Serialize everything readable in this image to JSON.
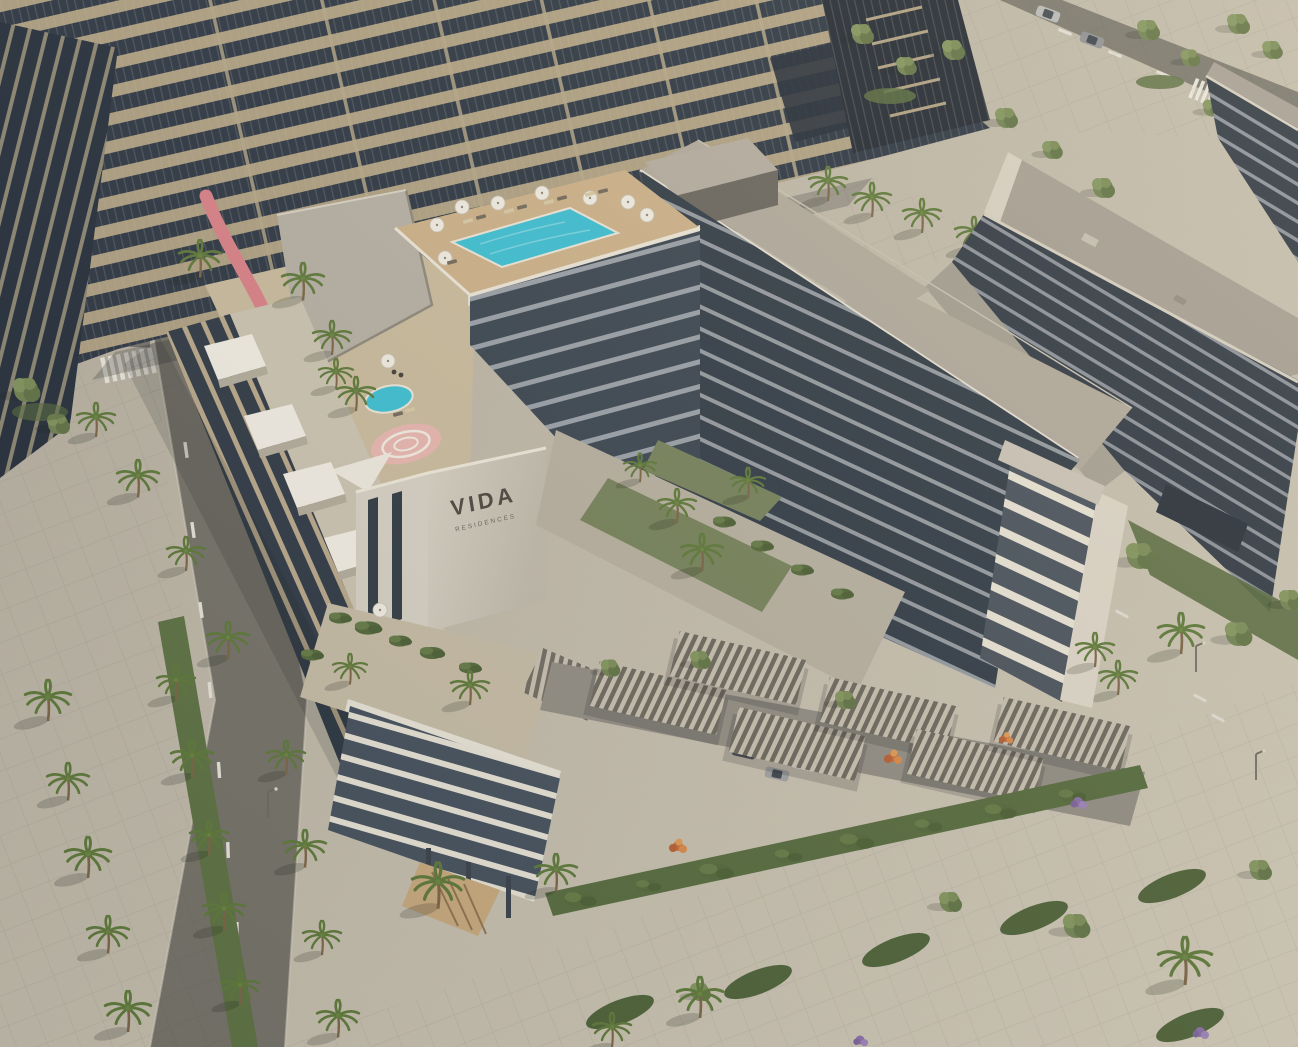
{
  "scene": {
    "type": "aerial-architectural-render",
    "title": "Aerial rendering of the VIDA Residences development",
    "sign": {
      "line1": "VIDA",
      "line2": "RESIDENCES"
    },
    "features": [
      "banded high-rise tower at top left",
      "rooftop infinity pool with parasols and sun loungers",
      "mid-rise apartment blocks with glass balconies",
      "podium deck with pink jogging track and plunge pool",
      "white canopies over roof terraces",
      "inner courtyard lawns with palm trees",
      "slatted carport pergolas with parked cars",
      "palm-lined streets with zebra crossings and lane markings",
      "landscaped promenade with orange and purple flowering shrubs"
    ],
    "palette": {
      "pavement_light": "#cfc8b6",
      "pavement_dark": "#b3ac9e",
      "asphalt": "#7a776f",
      "tower_band_tan": "#b0a183",
      "tower_glass": "#2e3845",
      "facade_glass": "#39434e",
      "white_trim": "#ece6d9",
      "roof_gray": "#b2aa9c",
      "deck_wood": "#cdb28a",
      "pool_water": "#3ec0d3",
      "track_pink": "#db8389",
      "lawn_green": "#77835c",
      "palm_green": "#5f7a3b",
      "shrub_green": "#55693c",
      "flower_orange": "#d98a4a",
      "flower_purple": "#9d84b8",
      "car_white": "#e8e8e6",
      "car_silver": "#9fa1a0",
      "sign_text": "#4d4a42"
    }
  }
}
